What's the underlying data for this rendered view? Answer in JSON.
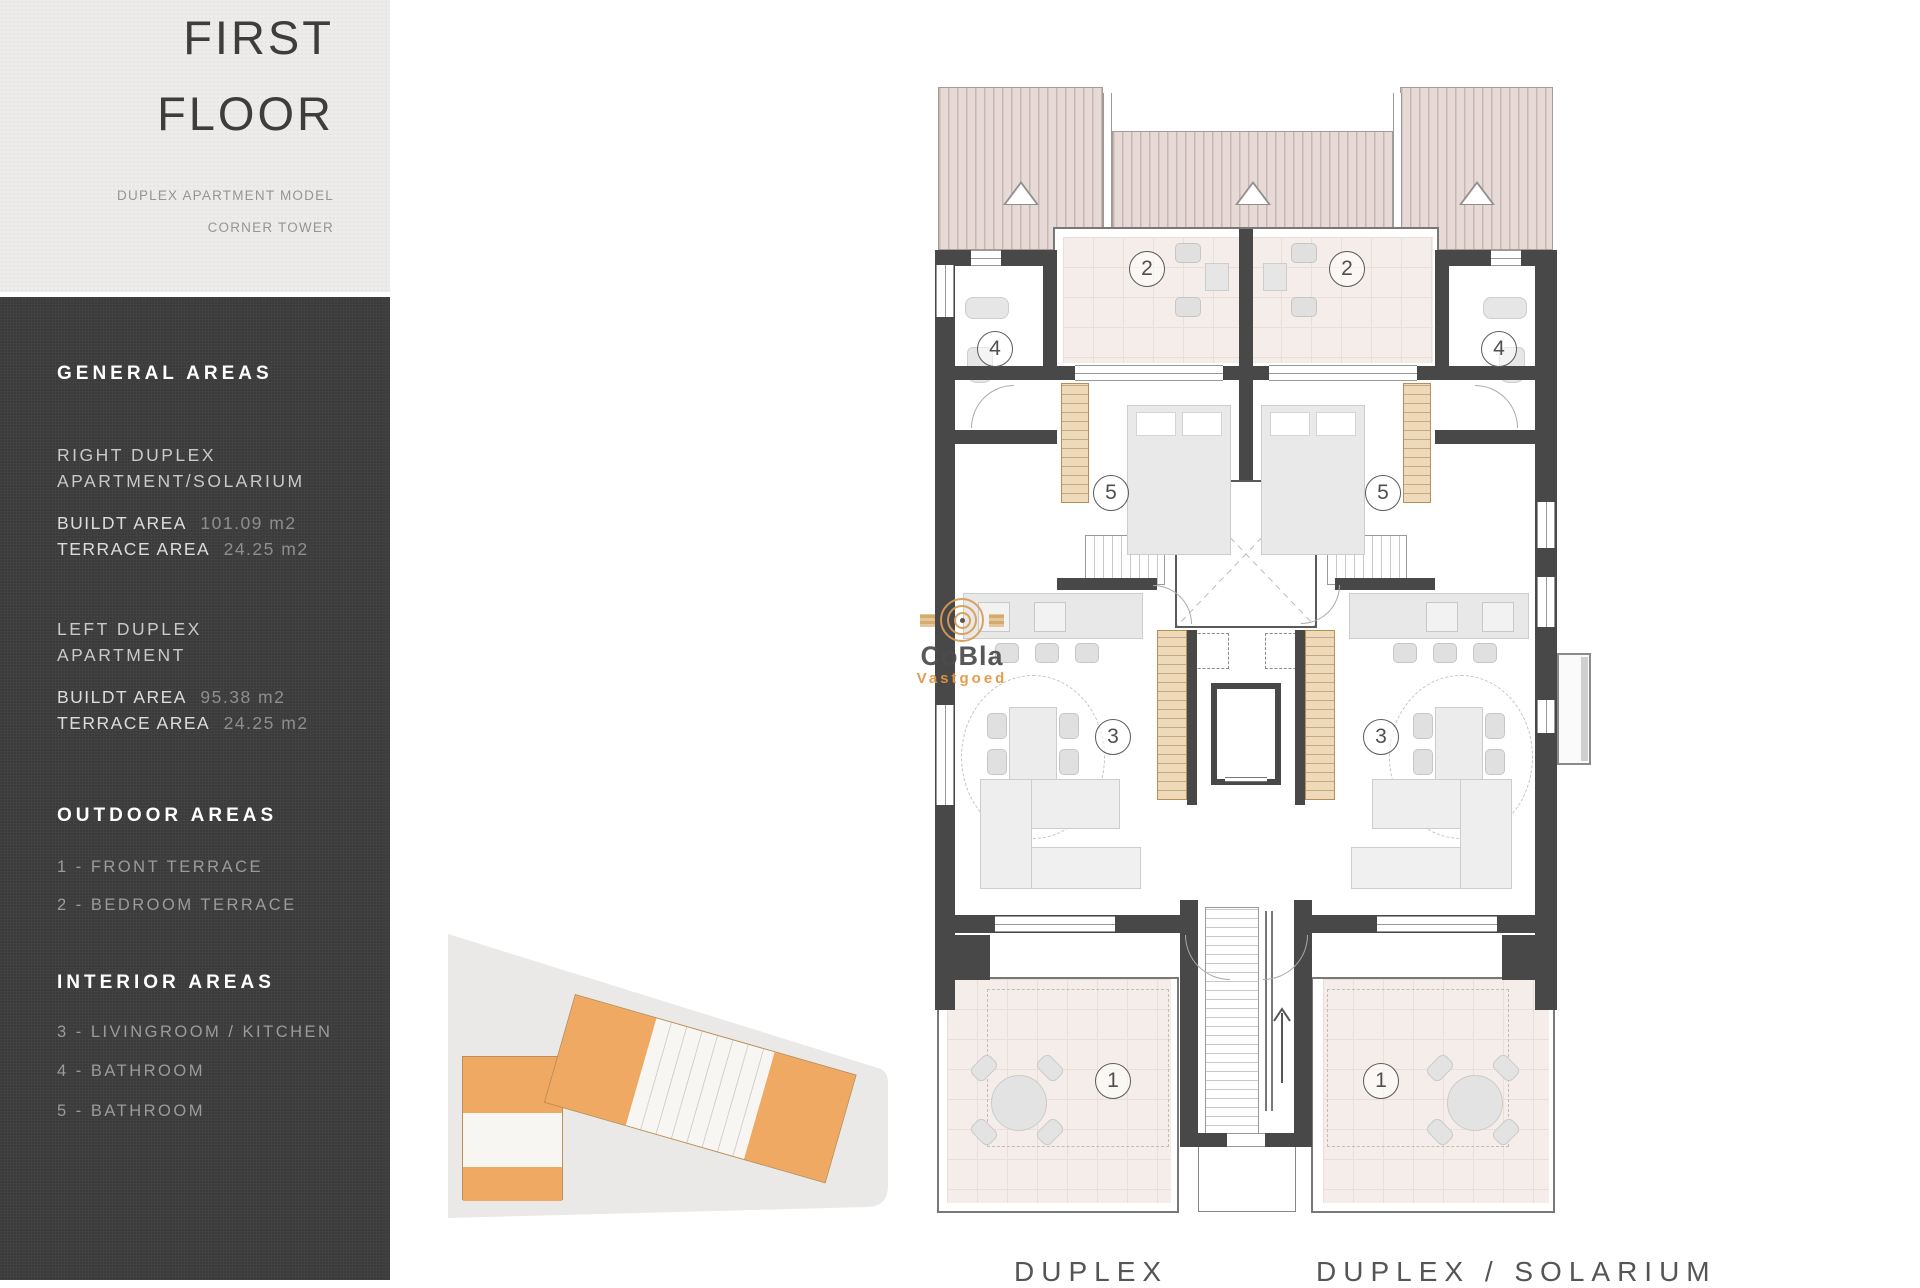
{
  "title": {
    "line1": "FIRST",
    "line2": "FLOOR",
    "subtitle1": "DUPLEX APARTMENT MODEL",
    "subtitle2": "CORNER TOWER"
  },
  "sidebar": {
    "general": {
      "heading": "GENERAL AREAS",
      "right_duplex": {
        "line1": "RIGHT DUPLEX",
        "line2": "APARTMENT/SOLARIUM",
        "built_label": "BUILDT AREA",
        "built_value": "101.09 m2",
        "terrace_label": "TERRACE AREA",
        "terrace_value": "24.25 m2"
      },
      "left_duplex": {
        "line1": "LEFT DUPLEX",
        "line2": "APARTMENT",
        "built_label": "BUILDT AREA",
        "built_value": "95.38 m2",
        "terrace_label": "TERRACE AREA",
        "terrace_value": "24.25 m2"
      }
    },
    "outdoor": {
      "heading": "OUTDOOR AREAS",
      "item1": "1 - FRONT TERRACE",
      "item2": "2 - BEDROOM TERRACE"
    },
    "interior": {
      "heading": "INTERIOR AREAS",
      "item1": "3 - LIVINGROOM / KITCHEN",
      "item2": "4 - BATHROOM",
      "item3": "5 - BATHROOM"
    }
  },
  "watermark": {
    "brand": "CoBla",
    "sub": "Vastgoed"
  },
  "plan": {
    "labels": {
      "front_terrace": "1",
      "bedroom_terrace": "2",
      "living": "3",
      "bathroom": "4",
      "bedroom": "5"
    },
    "captions": {
      "left": "DUPLEX",
      "right": "DUPLEX / SOLARIUM"
    }
  },
  "colors": {
    "sidebar_bg": "#3b3b3b",
    "wall": "#484848",
    "roof_fill": "#e7dad6",
    "terrace_floor": "#f4ede9",
    "accent_orange": "#e2953f",
    "inset_orange": "#f0a963"
  }
}
